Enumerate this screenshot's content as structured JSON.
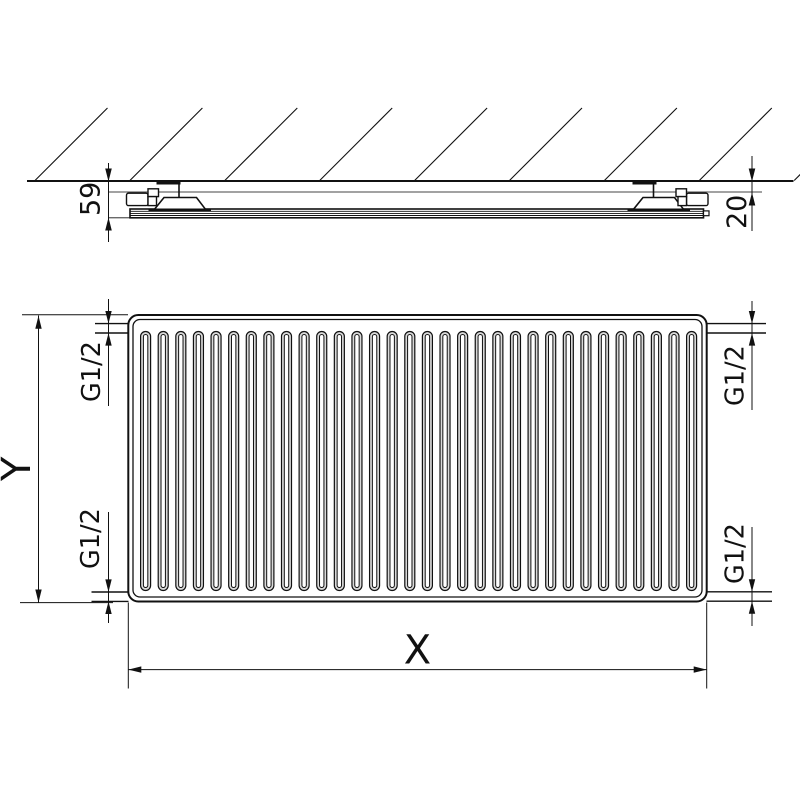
{
  "figure": {
    "type": "radiator-technical-drawing",
    "views": {
      "side": {
        "depth_dim": "59",
        "gap_dim": "20"
      },
      "front": {
        "height_dim": "Y",
        "width_dim": "X",
        "connections": {
          "top_left": "G1/2",
          "top_right": "G1/2",
          "bottom_left": "G1/2",
          "bottom_right": "G1/2"
        }
      }
    },
    "fins": {
      "count": 32
    },
    "hatch_lines": {
      "count": 9
    }
  },
  "colors": {
    "line": "#111111",
    "light_line": "#444444",
    "background": "#ffffff",
    "fin_shade": "#d9d9d9"
  }
}
